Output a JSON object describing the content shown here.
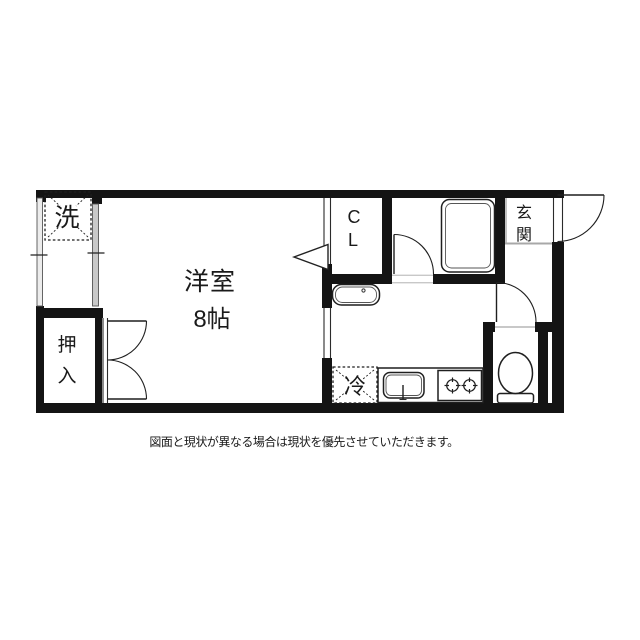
{
  "plan": {
    "room": {
      "name": "洋室",
      "size": "8帖"
    },
    "closet": {
      "char1": "C",
      "char2": "L"
    },
    "entrance": {
      "char1": "玄",
      "char2": "関"
    },
    "oshiire": {
      "char1": "押",
      "char2": "入"
    },
    "washer_label": "洗",
    "fridge_label": "冷"
  },
  "caption": "図面と現状が異なる場合は現状を優先させていただきます。",
  "colors": {
    "wall": "#141414",
    "window_glass": "#c9c9c9",
    "window_glass_light": "#ececec",
    "step_line": "#a8a8a8",
    "background": "#ffffff"
  }
}
